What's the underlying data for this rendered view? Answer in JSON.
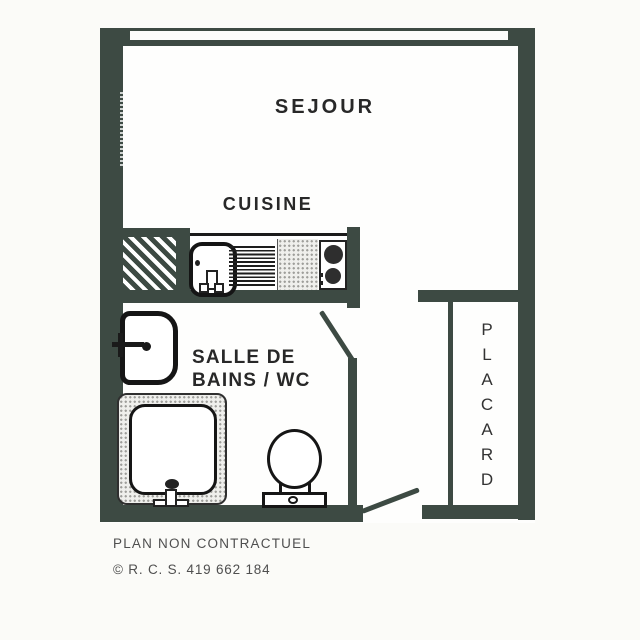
{
  "colors": {
    "wall": "#3d4a43",
    "ink": "#282828",
    "paper": "#fbfbf8",
    "footer_ink": "#4f4f4f"
  },
  "plan": {
    "rooms": {
      "sejour": "SEJOUR",
      "cuisine": "CUISINE",
      "bathroom_line1": "SALLE DE",
      "bathroom_line2": "BAINS / WC"
    },
    "placard": {
      "name": "PLACARD",
      "letters": [
        "P",
        "L",
        "A",
        "C",
        "A",
        "R",
        "D"
      ]
    },
    "icons": [
      "window-icon",
      "duct-hatch-icon",
      "kitchen-sink-icon",
      "drainboard-icon",
      "stove-icon",
      "washbasin-icon",
      "bathtub-icon",
      "toilet-icon",
      "door-swing-icon"
    ]
  },
  "footer": {
    "disclaimer": "PLAN NON CONTRACTUEL",
    "rcs": "© R. C. S. 419 662 184"
  }
}
